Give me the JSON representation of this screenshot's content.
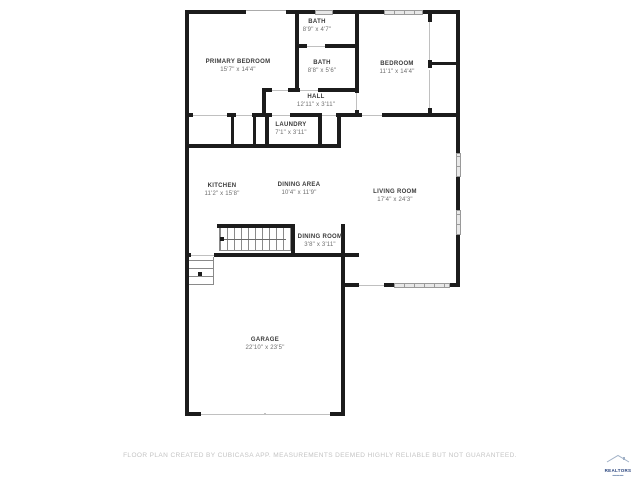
{
  "floorplan": {
    "rooms": [
      {
        "name": "BATH",
        "dims": "8'9\" x 4'7\""
      },
      {
        "name": "PRIMARY BEDROOM",
        "dims": "15'7\" x 14'4\""
      },
      {
        "name": "BATH",
        "dims": "8'8\" x 5'6\""
      },
      {
        "name": "BEDROOM",
        "dims": "11'1\" x 14'4\""
      },
      {
        "name": "HALL",
        "dims": "12'11\" x 3'11\""
      },
      {
        "name": "LAUNDRY",
        "dims": "7'1\" x 3'11\""
      },
      {
        "name": "KITCHEN",
        "dims": "11'2\" x 15'8\""
      },
      {
        "name": "DINING AREA",
        "dims": "10'4\" x 11'9\""
      },
      {
        "name": "LIVING ROOM",
        "dims": "17'4\" x 24'3\""
      },
      {
        "name": "DINING ROOM",
        "dims": "3'8\" x 3'11\""
      },
      {
        "name": "GARAGE",
        "dims": "22'10\" x 23'5\""
      }
    ],
    "disclaimer": "FLOOR PLAN CREATED BY CUBICASA APP. MEASUREMENTS DEEMED HIGHLY RELIABLE BUT NOT GUARANTEED.",
    "logo_text": "REALTORS",
    "colors": {
      "wall": "#1c1c1c",
      "window_fill": "#e8e8e8",
      "room_name": "#3a3a3a",
      "room_dims": "#6e6e6e",
      "disclaimer": "#c4c4c4",
      "logo": "#27427c"
    }
  }
}
